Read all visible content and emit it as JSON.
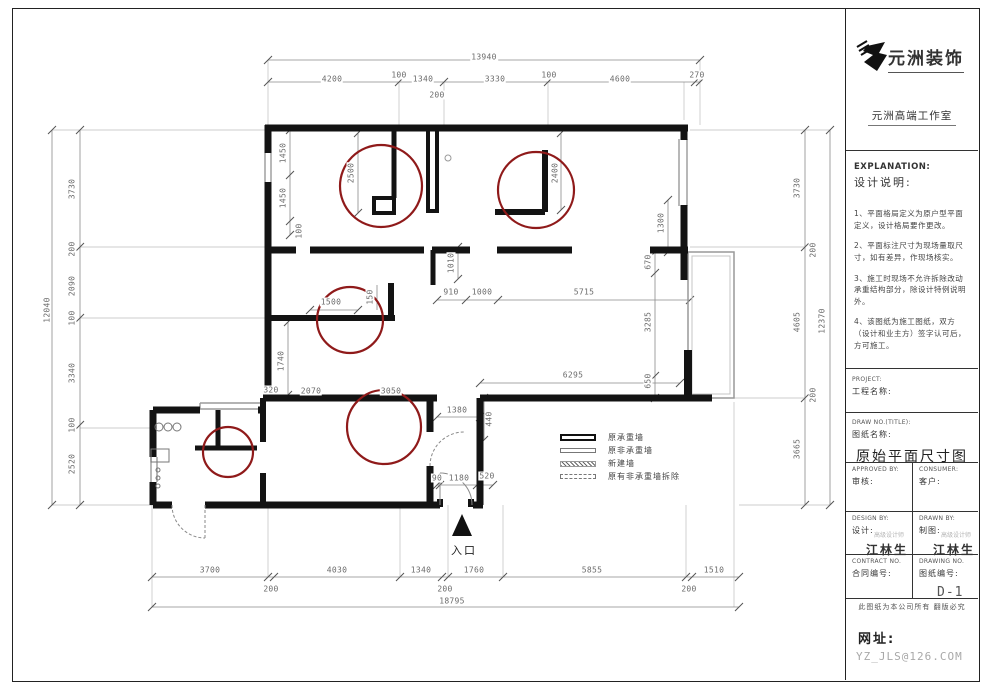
{
  "title_block": {
    "company": "元洲装饰",
    "studio": "元洲高端工作室",
    "explanation_en": "EXPLANATION:",
    "explanation_cn": "设计说明:",
    "notes": [
      "1、平面格局定义为原户型平面定义，设计格局要作更改。",
      "2、平面标注尺寸为现场量取尺寸，如有差异，作现场核实。",
      "3、施工时现场不允许拆除改动承重结构部分，除设计特例说明外。",
      "4、该图纸为施工图纸，双方（设计和业主方）签字认可后，方可施工。"
    ],
    "project_label_en": "PROJECT:",
    "project_label_cn": "工程名称:",
    "drawing_title_label_en": "DRAW NO.(TITLE):",
    "drawing_title_label_cn": "图纸名称:",
    "drawing_title": "原始平面尺寸图",
    "approved_en": "APPROVED BY:",
    "approved_cn": "审核:",
    "consumer_en": "CONSUMER:",
    "consumer_cn": "客户:",
    "design_en": "DESIGN BY:",
    "design_cn": "设计:",
    "designer": "江林生",
    "designer_stamp": "高级设计师",
    "drawn_en": "DRAWN BY:",
    "drawn_cn": "制图:",
    "draftsman": "江林生",
    "draftsman_stamp": "高级设计师",
    "contract_en": "CONTRACT NO.",
    "contract_cn": "合同编号:",
    "drawing_no_en": "DRAWING NO.",
    "drawing_no_cn": "图纸编号:",
    "drawing_no": "D-1",
    "copyright": "此图纸为本公司所有 翻版必究",
    "website_label": "网址:",
    "website": "YZ_JLS@126.COM"
  },
  "plan": {
    "entrance_label": "入口",
    "colors": {
      "wall": "#131313",
      "marker": "#8f1a1a",
      "dim": "#6b6b6b",
      "window": "#9a9a9a"
    },
    "legend": [
      {
        "style": "bearing",
        "label": "原承重墙"
      },
      {
        "style": "nonbearing",
        "label": "原非承重墙"
      },
      {
        "style": "new",
        "label": "新建墙"
      },
      {
        "style": "demolish",
        "label": "原有非承重墙拆除"
      }
    ],
    "dimensions": [
      {
        "t": "13940",
        "x": 484,
        "y": 57,
        "r": 0
      },
      {
        "t": "4200",
        "x": 332,
        "y": 79,
        "r": 0
      },
      {
        "t": "100",
        "x": 399,
        "y": 75,
        "r": 0
      },
      {
        "t": "1340",
        "x": 423,
        "y": 79,
        "r": 0
      },
      {
        "t": "3330",
        "x": 495,
        "y": 79,
        "r": 0
      },
      {
        "t": "100",
        "x": 549,
        "y": 75,
        "r": 0
      },
      {
        "t": "4600",
        "x": 620,
        "y": 79,
        "r": 0
      },
      {
        "t": "270",
        "x": 697,
        "y": 75,
        "r": 0
      },
      {
        "t": "200",
        "x": 437,
        "y": 95,
        "r": 0
      },
      {
        "t": "12040",
        "x": 47,
        "y": 310,
        "r": -90
      },
      {
        "t": "3730",
        "x": 72,
        "y": 189,
        "r": -90
      },
      {
        "t": "200",
        "x": 72,
        "y": 249,
        "r": -90
      },
      {
        "t": "2090",
        "x": 72,
        "y": 286,
        "r": -90
      },
      {
        "t": "100",
        "x": 72,
        "y": 318,
        "r": -90
      },
      {
        "t": "3340",
        "x": 72,
        "y": 373,
        "r": -90
      },
      {
        "t": "100",
        "x": 72,
        "y": 425,
        "r": -90
      },
      {
        "t": "2520",
        "x": 72,
        "y": 464,
        "r": -90
      },
      {
        "t": "1450",
        "x": 283,
        "y": 153,
        "r": -90
      },
      {
        "t": "1450",
        "x": 283,
        "y": 198,
        "r": -90
      },
      {
        "t": "100",
        "x": 299,
        "y": 231,
        "r": -90
      },
      {
        "t": "2500",
        "x": 351,
        "y": 173,
        "r": -90
      },
      {
        "t": "2400",
        "x": 555,
        "y": 173,
        "r": -90
      },
      {
        "t": "1010",
        "x": 451,
        "y": 263,
        "r": -90
      },
      {
        "t": "910",
        "x": 451,
        "y": 292,
        "r": 0
      },
      {
        "t": "1000",
        "x": 482,
        "y": 292,
        "r": 0
      },
      {
        "t": "5715",
        "x": 584,
        "y": 292,
        "r": 0
      },
      {
        "t": "1500",
        "x": 331,
        "y": 302,
        "r": 0
      },
      {
        "t": "150",
        "x": 370,
        "y": 297,
        "r": -90
      },
      {
        "t": "1740",
        "x": 281,
        "y": 361,
        "r": -90
      },
      {
        "t": "320",
        "x": 271,
        "y": 390,
        "r": 0
      },
      {
        "t": "2070",
        "x": 311,
        "y": 391,
        "r": 0
      },
      {
        "t": "3050",
        "x": 391,
        "y": 391,
        "r": 0
      },
      {
        "t": "6295",
        "x": 573,
        "y": 375,
        "r": 0
      },
      {
        "t": "1300",
        "x": 661,
        "y": 223,
        "r": -90
      },
      {
        "t": "670",
        "x": 648,
        "y": 262,
        "r": -90
      },
      {
        "t": "3285",
        "x": 648,
        "y": 322,
        "r": -90
      },
      {
        "t": "650",
        "x": 648,
        "y": 381,
        "r": -90
      },
      {
        "t": "3730",
        "x": 797,
        "y": 188,
        "r": -90
      },
      {
        "t": "200",
        "x": 813,
        "y": 250,
        "r": -90
      },
      {
        "t": "4605",
        "x": 797,
        "y": 322,
        "r": -90
      },
      {
        "t": "200",
        "x": 813,
        "y": 395,
        "r": -90
      },
      {
        "t": "3665",
        "x": 797,
        "y": 449,
        "r": -90
      },
      {
        "t": "12370",
        "x": 822,
        "y": 321,
        "r": -90
      },
      {
        "t": "1380",
        "x": 457,
        "y": 410,
        "r": 0
      },
      {
        "t": "440",
        "x": 489,
        "y": 419,
        "r": -90
      },
      {
        "t": "90",
        "x": 437,
        "y": 478,
        "r": 0
      },
      {
        "t": "1180",
        "x": 459,
        "y": 478,
        "r": 0
      },
      {
        "t": "520",
        "x": 487,
        "y": 476,
        "r": 0
      },
      {
        "t": "3700",
        "x": 210,
        "y": 570,
        "r": 0
      },
      {
        "t": "4030",
        "x": 337,
        "y": 570,
        "r": 0
      },
      {
        "t": "1340",
        "x": 421,
        "y": 570,
        "r": 0
      },
      {
        "t": "1760",
        "x": 474,
        "y": 570,
        "r": 0
      },
      {
        "t": "5855",
        "x": 592,
        "y": 570,
        "r": 0
      },
      {
        "t": "1510",
        "x": 714,
        "y": 570,
        "r": 0
      },
      {
        "t": "200",
        "x": 271,
        "y": 589,
        "r": 0
      },
      {
        "t": "200",
        "x": 445,
        "y": 589,
        "r": 0
      },
      {
        "t": "200",
        "x": 689,
        "y": 589,
        "r": 0
      },
      {
        "t": "18795",
        "x": 452,
        "y": 601,
        "r": 0
      }
    ]
  }
}
